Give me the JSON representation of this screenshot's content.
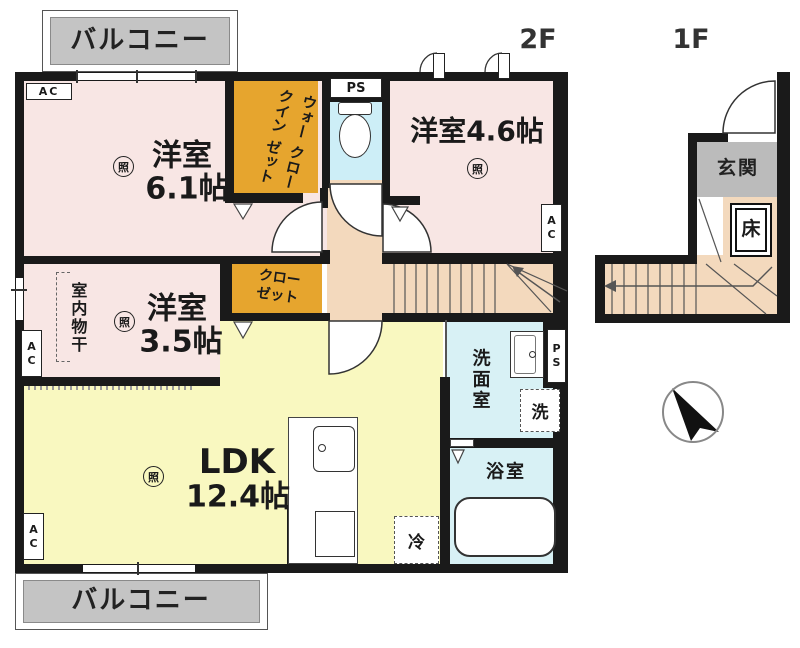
{
  "floors": {
    "f2": "2F",
    "f1": "1F"
  },
  "rooms": {
    "balcony": "バルコニー",
    "r61_1": "洋室",
    "r61_2": "6.1帖",
    "r46": "洋室4.6帖",
    "r35_1": "洋室",
    "r35_2": "3.5帖",
    "ldk_1": "LDK",
    "ldk_2": "12.4帖",
    "wic_1": "ウォークイン",
    "wic_2": "クローゼット",
    "closet_1": "クロー",
    "closet_2": "ゼット",
    "washroom": "洗面室",
    "bath": "浴室",
    "entrance": "玄関",
    "floor_box": "床",
    "laundry": "室内物干"
  },
  "equipment": {
    "ac": "AC",
    "ps": "PS",
    "washer": "洗",
    "fridge": "冷",
    "light": "照"
  },
  "colors": {
    "room_pink": "#f8e6e4",
    "ldk_yellow": "#f9f8c0",
    "closet_orange": "#e6a52e",
    "hall_tan": "#f3d9bd",
    "wet_blue": "#d8f1f5",
    "balcony_gray": "#c4c4c4",
    "entrance_gray": "#bbbbbb",
    "wall_black": "#1a1a1a"
  }
}
